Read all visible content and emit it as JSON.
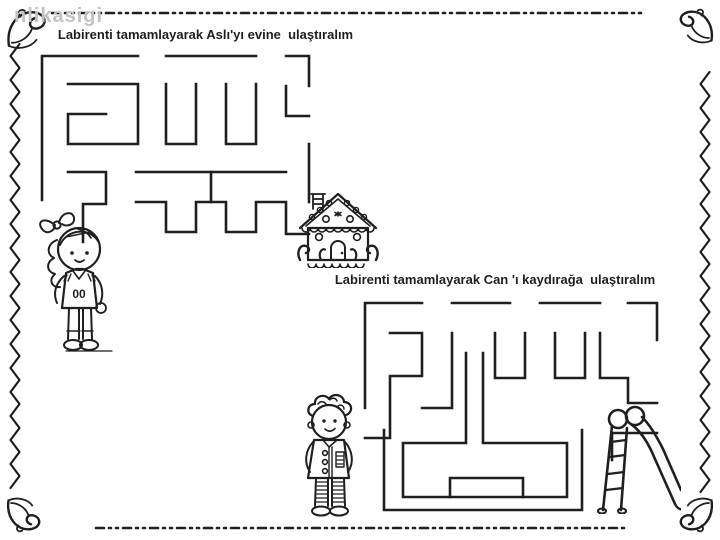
{
  "page": {
    "background": "#ffffff",
    "ink": "#1f1f1f",
    "watermark_text": "nlikasigi",
    "watermark_color": "#c2c2c2"
  },
  "titles": {
    "maze1": "Labirenti tamamlayarak Aslı'yı evine  ulaştıralım",
    "maze2": "Labirenti tamamlayarak Can 'ı kaydırağa  ulaştıralım"
  },
  "characters": {
    "maze1_start": "girl (Aslı)",
    "maze1_goal": "gingerbread house",
    "maze2_start": "boy (Can)",
    "maze2_goal": "playground slide",
    "girl_shirt_label": "00"
  },
  "maze1": {
    "x": 38,
    "y": 52,
    "width": 275,
    "height": 215,
    "stroke": 2.6,
    "walls": [
      [
        [
          4,
          148
        ],
        [
          4,
          4
        ],
        [
          100,
          4
        ]
      ],
      [
        [
          128,
          4
        ],
        [
          218,
          4
        ]
      ],
      [
        [
          248,
          4
        ],
        [
          271,
          4
        ],
        [
          271,
          34
        ]
      ],
      [
        [
          30,
          32
        ],
        [
          100,
          32
        ],
        [
          100,
          92
        ],
        [
          30,
          92
        ],
        [
          30,
          62
        ],
        [
          68,
          62
        ]
      ],
      [
        [
          30,
          120
        ],
        [
          68,
          120
        ],
        [
          68,
          152
        ],
        [
          45,
          152
        ],
        [
          45,
          190
        ]
      ],
      [
        [
          128,
          32
        ],
        [
          128,
          92
        ],
        [
          158,
          92
        ],
        [
          158,
          32
        ]
      ],
      [
        [
          188,
          32
        ],
        [
          188,
          92
        ],
        [
          218,
          92
        ],
        [
          218,
          32
        ]
      ],
      [
        [
          248,
          34
        ],
        [
          248,
          64
        ],
        [
          271,
          64
        ]
      ],
      [
        [
          98,
          120
        ],
        [
          248,
          120
        ]
      ],
      [
        [
          173,
          120
        ],
        [
          173,
          150
        ]
      ],
      [
        [
          271,
          92
        ],
        [
          271,
          150
        ]
      ],
      [
        [
          98,
          150
        ],
        [
          128,
          150
        ],
        [
          128,
          180
        ],
        [
          158,
          180
        ],
        [
          158,
          150
        ],
        [
          188,
          150
        ],
        [
          188,
          180
        ],
        [
          218,
          180
        ],
        [
          218,
          150
        ],
        [
          248,
          150
        ],
        [
          248,
          182
        ],
        [
          271,
          182
        ]
      ]
    ]
  },
  "maze2": {
    "x": 360,
    "y": 298,
    "width": 302,
    "height": 214,
    "stroke": 2.6,
    "walls": [
      [
        [
          5,
          110
        ],
        [
          5,
          5
        ],
        [
          62,
          5
        ]
      ],
      [
        [
          92,
          5
        ],
        [
          150,
          5
        ]
      ],
      [
        [
          180,
          5
        ],
        [
          240,
          5
        ]
      ],
      [
        [
          268,
          5
        ],
        [
          297,
          5
        ],
        [
          297,
          42
        ]
      ],
      [
        [
          30,
          35
        ],
        [
          62,
          35
        ],
        [
          62,
          78
        ],
        [
          30,
          78
        ],
        [
          30,
          140
        ],
        [
          5,
          140
        ]
      ],
      [
        [
          92,
          35
        ],
        [
          92,
          110
        ],
        [
          62,
          110
        ]
      ],
      [
        [
          135,
          35
        ],
        [
          135,
          80
        ],
        [
          165,
          80
        ],
        [
          165,
          35
        ]
      ],
      [
        [
          195,
          35
        ],
        [
          195,
          80
        ],
        [
          225,
          80
        ],
        [
          225,
          35
        ]
      ],
      [
        [
          240,
          35
        ],
        [
          240,
          80
        ],
        [
          268,
          80
        ],
        [
          268,
          105
        ],
        [
          297,
          105
        ]
      ],
      [
        [
          297,
          135
        ],
        [
          252,
          135
        ],
        [
          252,
          162
        ]
      ],
      [
        [
          106,
          55
        ],
        [
          106,
          145
        ],
        [
          43,
          145
        ],
        [
          43,
          199
        ],
        [
          207,
          199
        ],
        [
          207,
          145
        ],
        [
          123,
          145
        ],
        [
          123,
          55
        ]
      ],
      [
        [
          24,
          132
        ],
        [
          24,
          212
        ],
        [
          222,
          212
        ],
        [
          222,
          132
        ]
      ],
      [
        [
          90,
          199
        ],
        [
          90,
          180
        ],
        [
          163,
          180
        ],
        [
          163,
          199
        ]
      ]
    ]
  }
}
